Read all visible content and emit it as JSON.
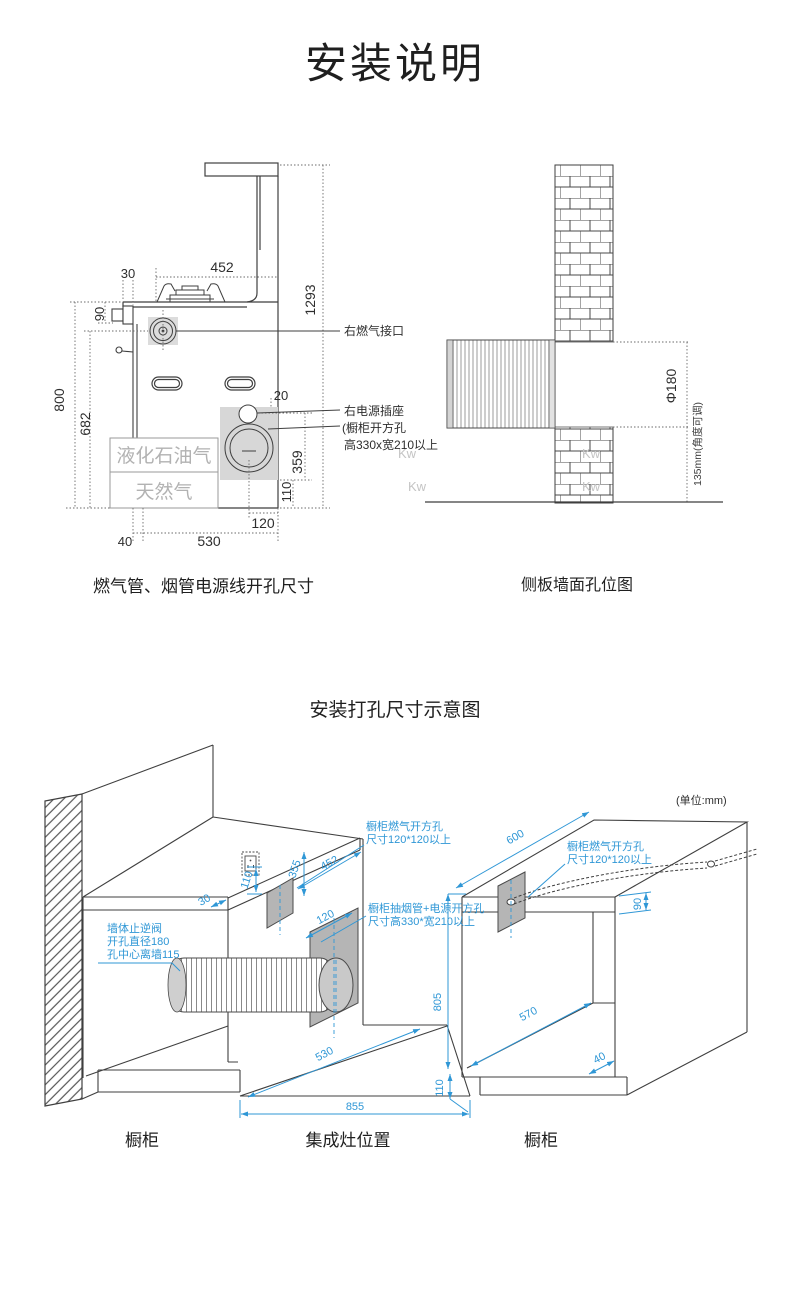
{
  "title": "安装说明",
  "left_diagram": {
    "caption": "燃气管、烟管电源线开孔尺寸",
    "labels": {
      "gas_port": "右燃气接口",
      "power_socket": "右电源插座",
      "cabinet_hole_line1": "(橱柜开方孔",
      "cabinet_hole_line2": "高330x宽210以上",
      "lpg": "液化石油气",
      "natural_gas": "天然气"
    },
    "dims": {
      "top_width": "452",
      "left_offset": "30",
      "counter_thickness": "90",
      "total_height": "1293",
      "counter_height": "800",
      "gas_port_height": "682",
      "edge_gap": "20",
      "opening_height": "359",
      "bottom_gap": "110",
      "opening_offset": "120",
      "back_gap": "40",
      "depth": "530"
    }
  },
  "right_diagram": {
    "caption": "侧板墙面孔位图",
    "dims": {
      "hole_diameter": "Φ180",
      "height_note": "135mm(角度可调)"
    },
    "watermark": "Kw"
  },
  "bottom_diagram": {
    "title": "安装打孔尺寸示意图",
    "unit_note": "(单位:mm)",
    "annotations": {
      "wall_valve_line1": "墙体止逆阀",
      "wall_valve_line2": "开孔直径180",
      "wall_valve_line3": "孔中心离墙115",
      "gas_hole_mid_line1": "橱柜燃气开方孔",
      "gas_hole_mid_line2": "尺寸120*120以上",
      "smoke_hole_line1": "橱柜抽烟管+电源开方孔",
      "smoke_hole_line2": "尺寸高330*宽210以上",
      "gas_hole_right_line1": "橱柜燃气开方孔",
      "gas_hole_right_line2": "尺寸120*120以上"
    },
    "dims": {
      "counter_overhang": "30",
      "socket_gap": "110",
      "panel_height": "355",
      "panel_width": "452",
      "duct_panel_width": "120",
      "slot_depth": "530",
      "slot_width": "855",
      "counter_total_height": "805",
      "plinth_height": "110",
      "right_depth": "570",
      "plinth_inset": "40",
      "right_width": "600",
      "counter_thickness": "90"
    },
    "captions": {
      "cabinet_left": "橱柜",
      "stove_position": "集成灶位置",
      "cabinet_right": "橱柜"
    }
  }
}
